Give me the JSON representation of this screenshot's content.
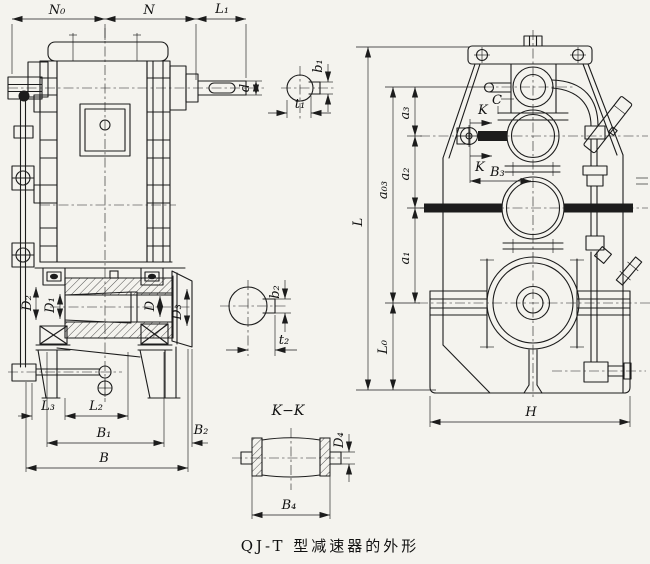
{
  "colors": {
    "paper": "#f4f3ee",
    "ink": "#1c1c1c"
  },
  "caption": "QJ-T 型减速器的外形",
  "lv": {
    "n0": "N₀",
    "n": "N",
    "l1": "L₁",
    "d": "d",
    "d2": "D₂",
    "d1": "D₁",
    "dm": "D",
    "d3": "D₃",
    "l3": "L₃",
    "l2": "L₂",
    "b1": "B₁",
    "b2": "B₂",
    "b": "B"
  },
  "s1": {
    "b1": "b₁",
    "t1": "t₁"
  },
  "s2": {
    "b2": "b₂",
    "t2": "t₂"
  },
  "kk": {
    "title": "K−K",
    "d4": "D₄",
    "b4": "B₄"
  },
  "rv": {
    "l": "L",
    "a03": "a₀₃",
    "a3": "a₃",
    "a2": "a₂",
    "a1": "a₁",
    "l0": "L₀",
    "c": "C",
    "k1": "K",
    "k2": "K",
    "b3": "B₃",
    "h": "H"
  }
}
